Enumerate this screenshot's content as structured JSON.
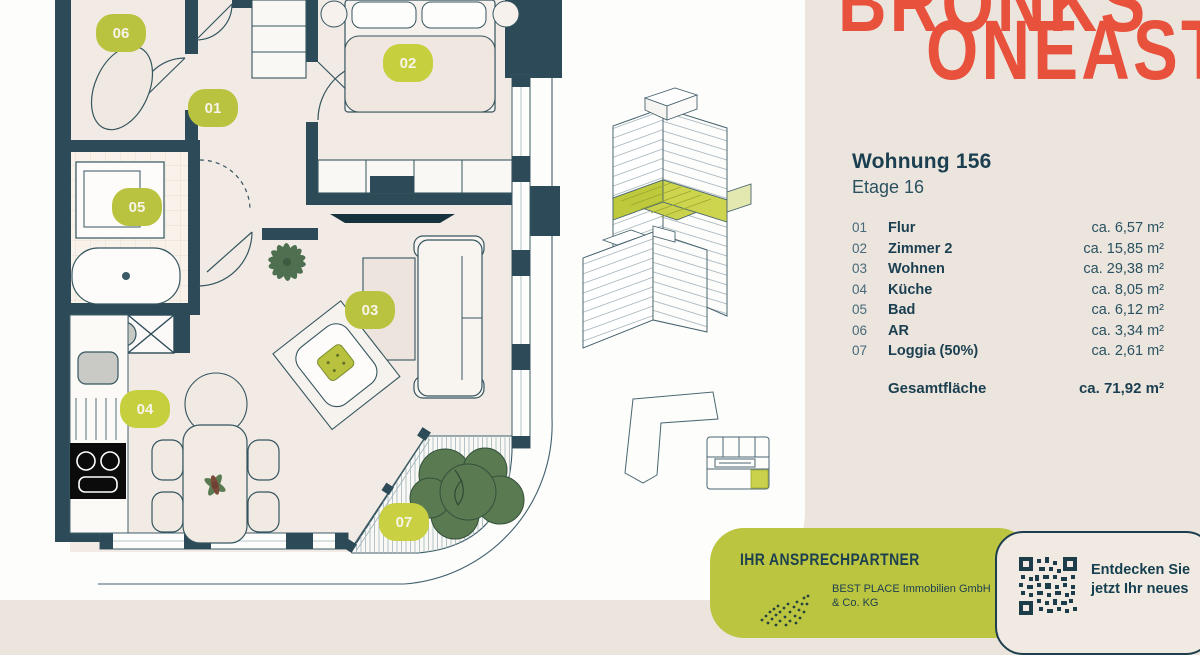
{
  "logo": {
    "line1": "BRONKS",
    "line2": "ONEAST",
    "color": "#e8513c"
  },
  "info": {
    "title": "Wohnung 156",
    "subtitle": "Etage 16",
    "rooms": [
      {
        "num": "01",
        "name": "Flur",
        "area": "ca. 6,57 m²"
      },
      {
        "num": "02",
        "name": "Zimmer 2",
        "area": "ca. 15,85 m²"
      },
      {
        "num": "03",
        "name": "Wohnen",
        "area": "ca. 29,38 m²"
      },
      {
        "num": "04",
        "name": "Küche",
        "area": "ca. 8,05 m²"
      },
      {
        "num": "05",
        "name": "Bad",
        "area": "ca. 6,12 m²"
      },
      {
        "num": "06",
        "name": "AR",
        "area": "ca. 3,34 m²"
      },
      {
        "num": "07",
        "name": "Loggia (50%)",
        "area": "ca. 2,61 m²"
      }
    ],
    "total_label": "Gesamtfläche",
    "total_value": "ca. 71,92 m²"
  },
  "contact": {
    "heading": "IHR ANSPRECHPARTNER",
    "company_line1": "BEST PLACE Immobilien GmbH",
    "company_line2": "& Co. KG"
  },
  "qr_panel": {
    "line1": "Entdecken Sie",
    "line2": "jetzt Ihr neues"
  },
  "colors": {
    "wall": "#2c4a58",
    "accent_green": "#bcc53f",
    "logo_red": "#e8513c",
    "text_dark": "#1b3f50",
    "cream_bg": "#ebe5de",
    "room_fill": "#f2ebe5"
  }
}
